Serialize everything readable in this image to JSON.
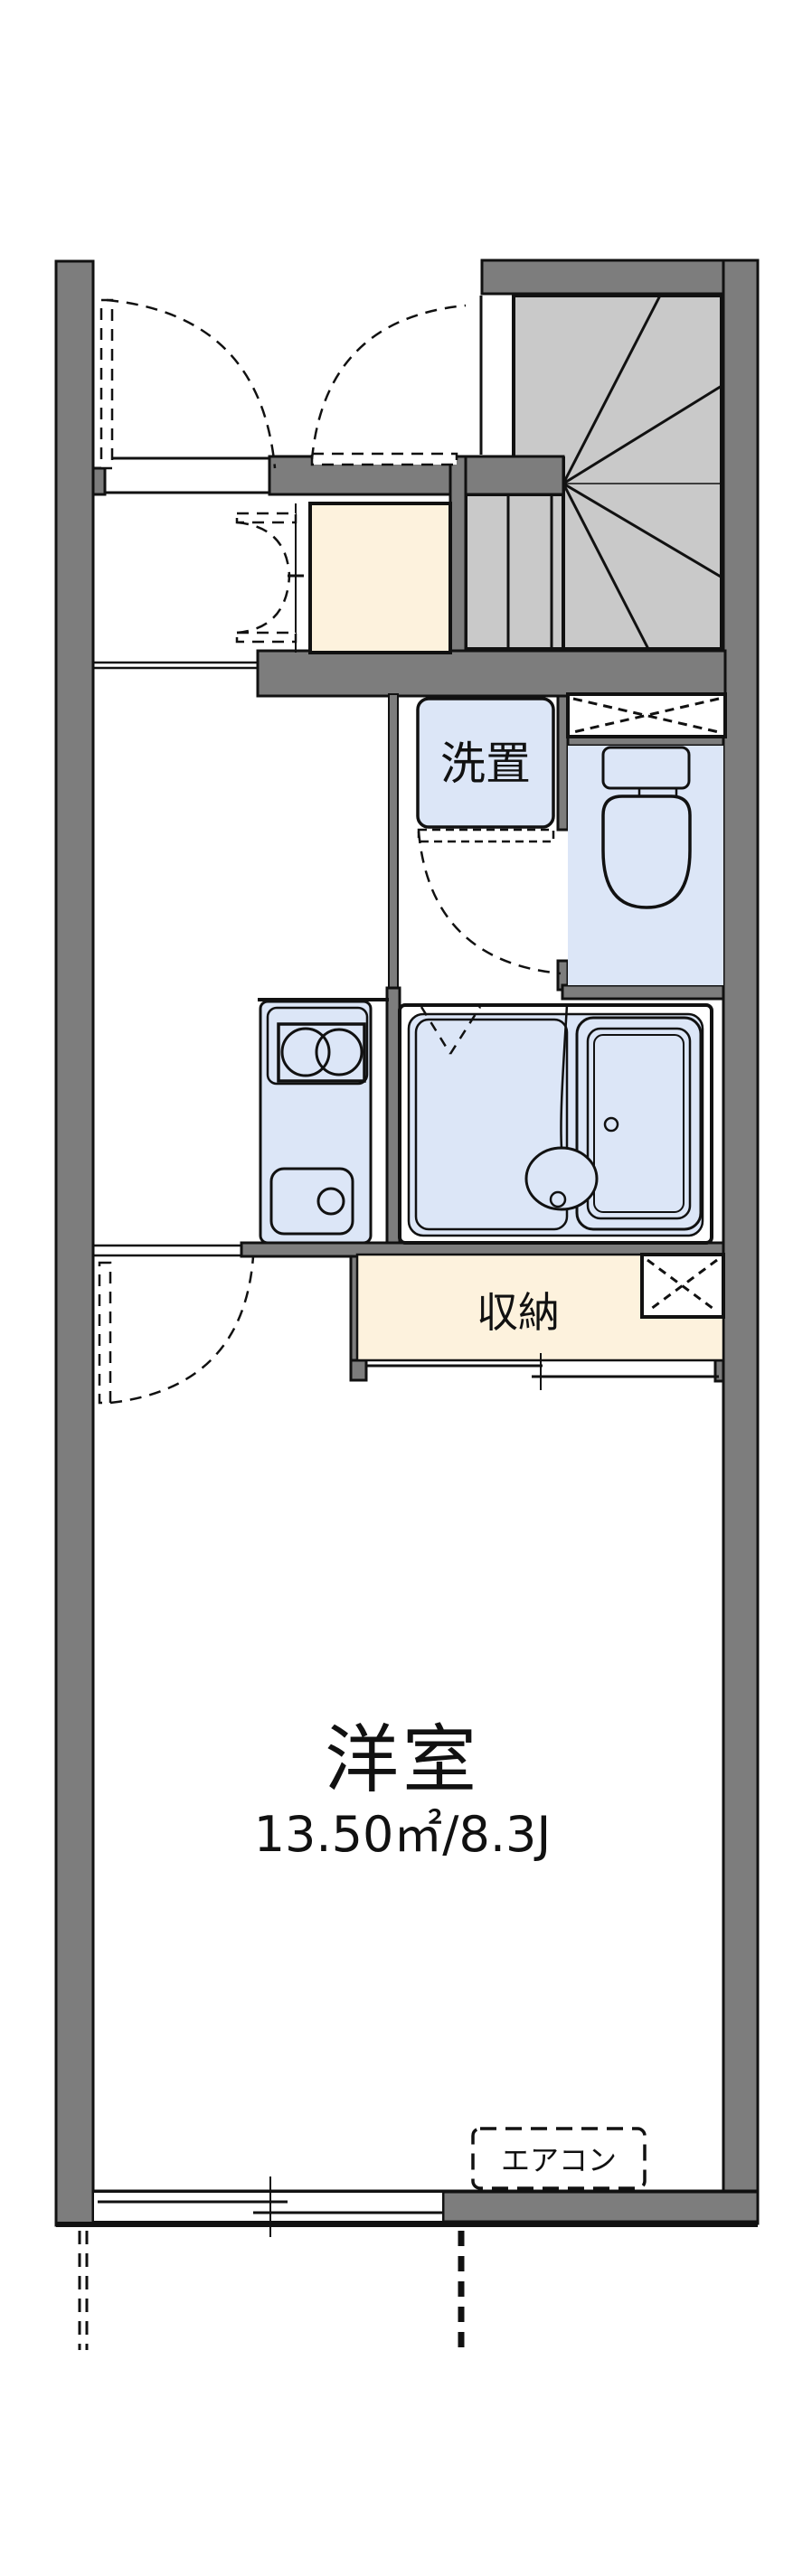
{
  "plan": {
    "type": "floor-plan",
    "rooms": {
      "washer_nook": {
        "label": "洗置"
      },
      "closet": {
        "label": "収納"
      },
      "main_room": {
        "label": "洋室",
        "area": "13.50㎡/8.3J"
      },
      "aircon": {
        "label": "エアコン"
      }
    },
    "colors": {
      "wall": "#7d7d7d",
      "stair": "#c9c9c9",
      "fixture_blue": "#dce6f7",
      "cream": "#fdf2dd",
      "line": "#111111"
    }
  }
}
